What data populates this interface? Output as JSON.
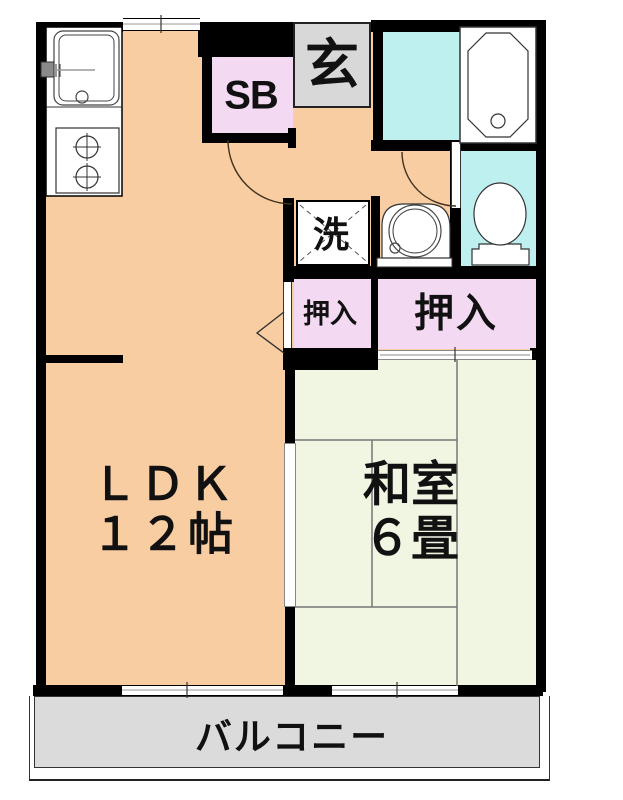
{
  "plan_title": "1LDK floor plan",
  "rooms": {
    "ldk": {
      "label_line1": "ＬＤＫ",
      "label_line2": "１２帖"
    },
    "washitsu": {
      "label_line1": "和室",
      "label_line2": "６畳"
    },
    "genkan": {
      "label": "玄"
    },
    "shoe_box": {
      "label": "SB"
    },
    "laundry": {
      "label": "洗"
    },
    "closet_small": {
      "label": "押入"
    },
    "closet_large": {
      "label": "押入"
    },
    "balcony": {
      "label": "バルコニー"
    }
  },
  "colors": {
    "wall": "#000000",
    "ldk": "#F9CDA2",
    "tatami": "#F1F6E3",
    "wet": "#BFF0F0",
    "closet": "#F4D9F3",
    "genkan": "#D8D8D8",
    "balcony": "#DBDBDB",
    "label": "#111111"
  }
}
